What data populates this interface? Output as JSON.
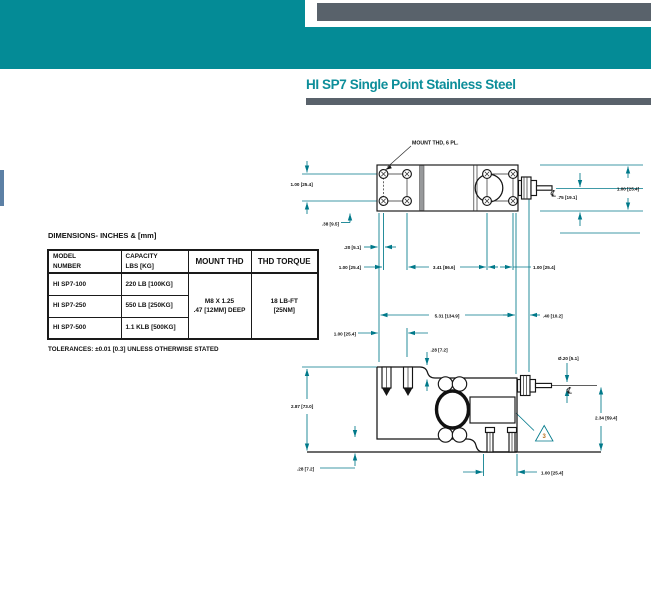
{
  "header": {
    "title": "HI SP7 Single Point Stainless Steel",
    "accent_color": "#048b96",
    "bar_color": "#59626b",
    "tab_color": "#5c80a5"
  },
  "dimensions_section": {
    "heading": "DIMENSIONS- INCHES & [mm]",
    "table": {
      "columns": [
        "MODEL\nNUMBER",
        "CAPACITY\nLBS [KG]",
        "MOUNT THD",
        "THD TORQUE"
      ],
      "rows": [
        {
          "model": "HI SP7-100",
          "capacity": "220 LB [100KG]"
        },
        {
          "model": "HI SP7-250",
          "capacity": "550 LB [250KG]"
        },
        {
          "model": "HI SP7-500",
          "capacity": "1.1 KLB [500KG]"
        }
      ],
      "mount_thd": "M8 X 1.25\n.47 [12MM] DEEP",
      "thd_torque": "18 LB-FT\n[25NM]"
    },
    "tolerance_note": "TOLERANCES: ±0.01 [0.3] UNLESS OTHERWISE STATED"
  },
  "drawing": {
    "dim_color": "#00798a",
    "line_color": "#151515",
    "centerline_symbol": "℄",
    "top_view": {
      "mount_label": "MOUNT THD, 6 PL.",
      "dim_hole_row_spacing": "1.00 [25.4]",
      "dim_edge_to_hole_row": ".38 [9.5]",
      "dim_edge_to_hole_col": ".20 [5.1]",
      "dim_hole_col_spacing": "1.00 [25.4]",
      "dim_center_span": "3.41 [86.6]",
      "dim_right_hole_spacing": "1.00 [25.4]",
      "dim_height_overall": "1.00 [25.4]",
      "dim_height_center": ".75 [19.1]"
    },
    "side_view": {
      "dim_length": "5.31 [134.9]",
      "dim_connector": ".40 [10.2]",
      "dim_stud_offset": "1.00 [25.4]",
      "dim_step": ".28 [7.2]",
      "dim_cable_dia": "Ø.20 [5.1]",
      "dim_height_left": "2.87 [73.0]",
      "dim_height_right": "2.34 [59.4]",
      "dim_base_step": ".28 [7.2]",
      "dim_stud_edge": "1.00 [25.4]",
      "flag_number": "3"
    }
  }
}
